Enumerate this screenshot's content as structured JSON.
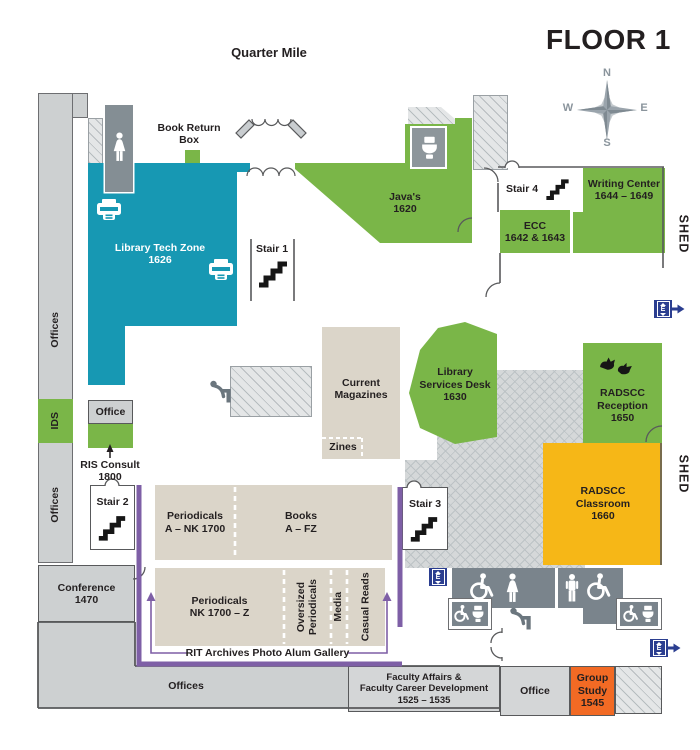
{
  "floor_title": "FLOOR 1",
  "corridor_label": "Quarter Mile",
  "compass": {
    "n": "N",
    "e": "E",
    "s": "S",
    "w": "W"
  },
  "shed": {
    "top": "SHED",
    "bottom": "SHED"
  },
  "elevator": {
    "letter": "E"
  },
  "rooms": {
    "library_tech_zone": "Library Tech Zone\n1626",
    "javas": "Java's\n1620",
    "book_return": "Book Return\nBox",
    "stair_1": "Stair 1",
    "stair_2": "Stair 2",
    "stair_3": "Stair 3",
    "stair_4": "Stair 4",
    "writing_center": "Writing Center\n1644 – 1649",
    "ecc": "ECC\n1642 & 1643",
    "library_services_desk": "Library\nServices Desk\n1630",
    "radscc_reception": "RADSCC\nReception\n1650",
    "radscc_classroom": "RADSCC\nClassroom\n1660",
    "current_magazines": "Current\nMagazines",
    "zines": "Zines",
    "periodicals_a_nk": "Periodicals\nA – NK 1700",
    "books_a_fz": "Books\nA – FZ",
    "periodicals_nk_z": "Periodicals\nNK 1700 – Z",
    "oversized_periodicals": "Oversized\nPeriodicals",
    "media": "Media",
    "casual_reads": "Casual Reads",
    "archives_gallery": "RIT Archives Photo Alum Gallery",
    "offices_left_upper": "Offices",
    "offices_left_lower": "Offices",
    "ids": "IDS",
    "office_upper": "Office",
    "ris_consult": "RIS Consult\n1800",
    "conference": "Conference\n1470",
    "offices_bottom": "Offices",
    "faculty_affairs": "Faculty Affairs &\nFaculty Career Development\n1525 – 1535",
    "office_lower": "Office",
    "group_study": "Group\nStudy\n1545"
  },
  "colors": {
    "teal": "#1798b3",
    "green": "#7ab648",
    "yellow": "#f6b717",
    "orange": "#f26a24",
    "purple": "#7e5fa6",
    "navy": "#2b3e90",
    "beige": "#dbd5c9",
    "room_gray": "#cdd0d1",
    "restroom_gray": "#7a848c"
  }
}
